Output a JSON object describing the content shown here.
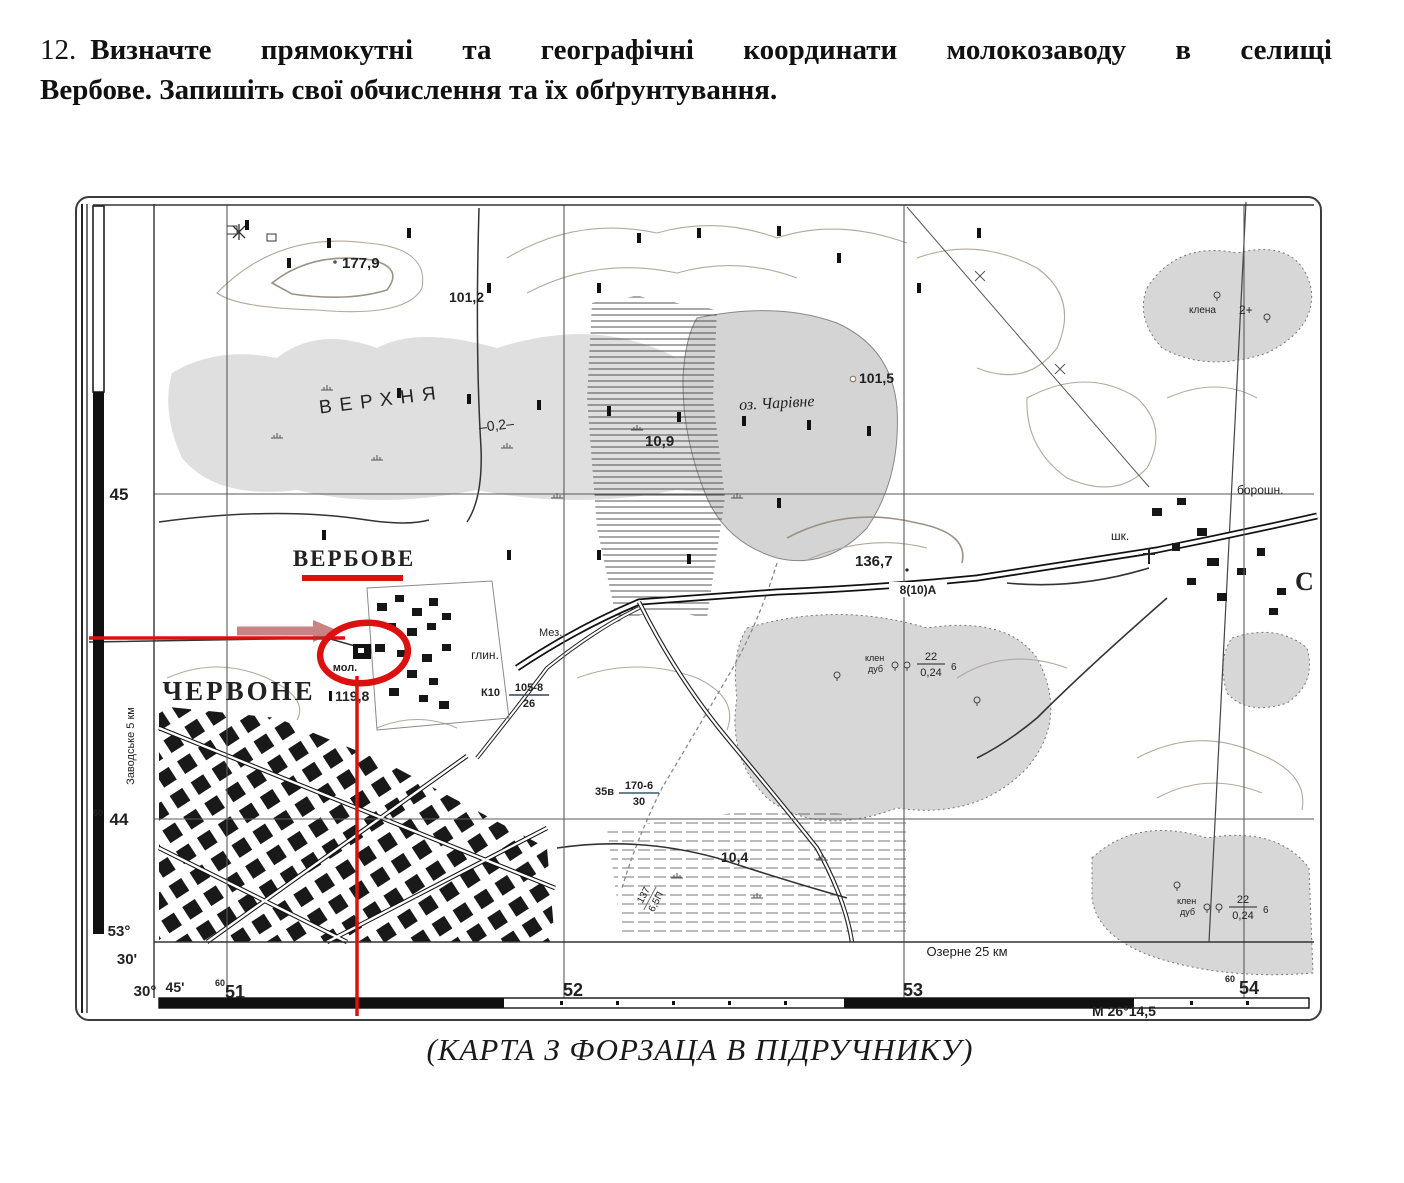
{
  "colors": {
    "annotation_red": "#dd1010",
    "terrain_grey": "#d7d7d7"
  },
  "task": {
    "number": "12.",
    "line1": "Визначте прямокутні та географічні координати молокозаводу в селищі",
    "line2": "Вербове. Запишіть свої обчислення та їх обґрунтування."
  },
  "caption": "(КАРТА З ФОРЗАЦА В ПІДРУЧНИКУ)",
  "map": {
    "settlements": {
      "verbove": "ВЕРБОВЕ",
      "chervone": "ЧЕРВОНЕ",
      "edge_partial": "С"
    },
    "hydro": {
      "marsh_name": "ВЕРХНЯ",
      "marsh_depth": "–0,2–",
      "lake_name": "оз. Чарівне",
      "depth_10_9": "10,9",
      "depth_10_4": "10,4"
    },
    "elevations": {
      "h177_9": "177,9",
      "h101_2": "101,2",
      "h101_5": "101,5",
      "h136_7": "136,7",
      "h119_8": "119,8"
    },
    "objects": {
      "milk_plant": "мол.",
      "clay_pit": "глин.",
      "school": "шк.",
      "flour_mill": "борошн.",
      "mez": "Мез.",
      "forest_species_1": "клен",
      "forest_species_2": "дуб",
      "forest_height": "22",
      "forest_diameter": "0,24",
      "forest_spacing": "6",
      "shrub_species": "клена",
      "shrub_height": "2+"
    },
    "roads": {
      "highway_spec": "8(10)А",
      "bridge_prefix": "К10",
      "bridge_top": "105-8",
      "bridge_bottom": "26",
      "bridge2_prefix": "35в",
      "bridge2_top": "170-6",
      "bridge2_bottom": "30",
      "embankment_top": "137",
      "embankment_bottom": "6,5П",
      "dest_right": "Озерне 25 км",
      "dest_left": "Заводське 5 км"
    },
    "grid": {
      "sup": "60",
      "northing_45": "45",
      "northing_44": "44",
      "easting_51": "51",
      "easting_52": "52",
      "easting_53": "53",
      "easting_54": "54",
      "lat_deg": "53°",
      "lat_min": "30'",
      "lon_deg": "30°",
      "lon_min": "45'",
      "corner_note": "М 26°14,5"
    }
  }
}
